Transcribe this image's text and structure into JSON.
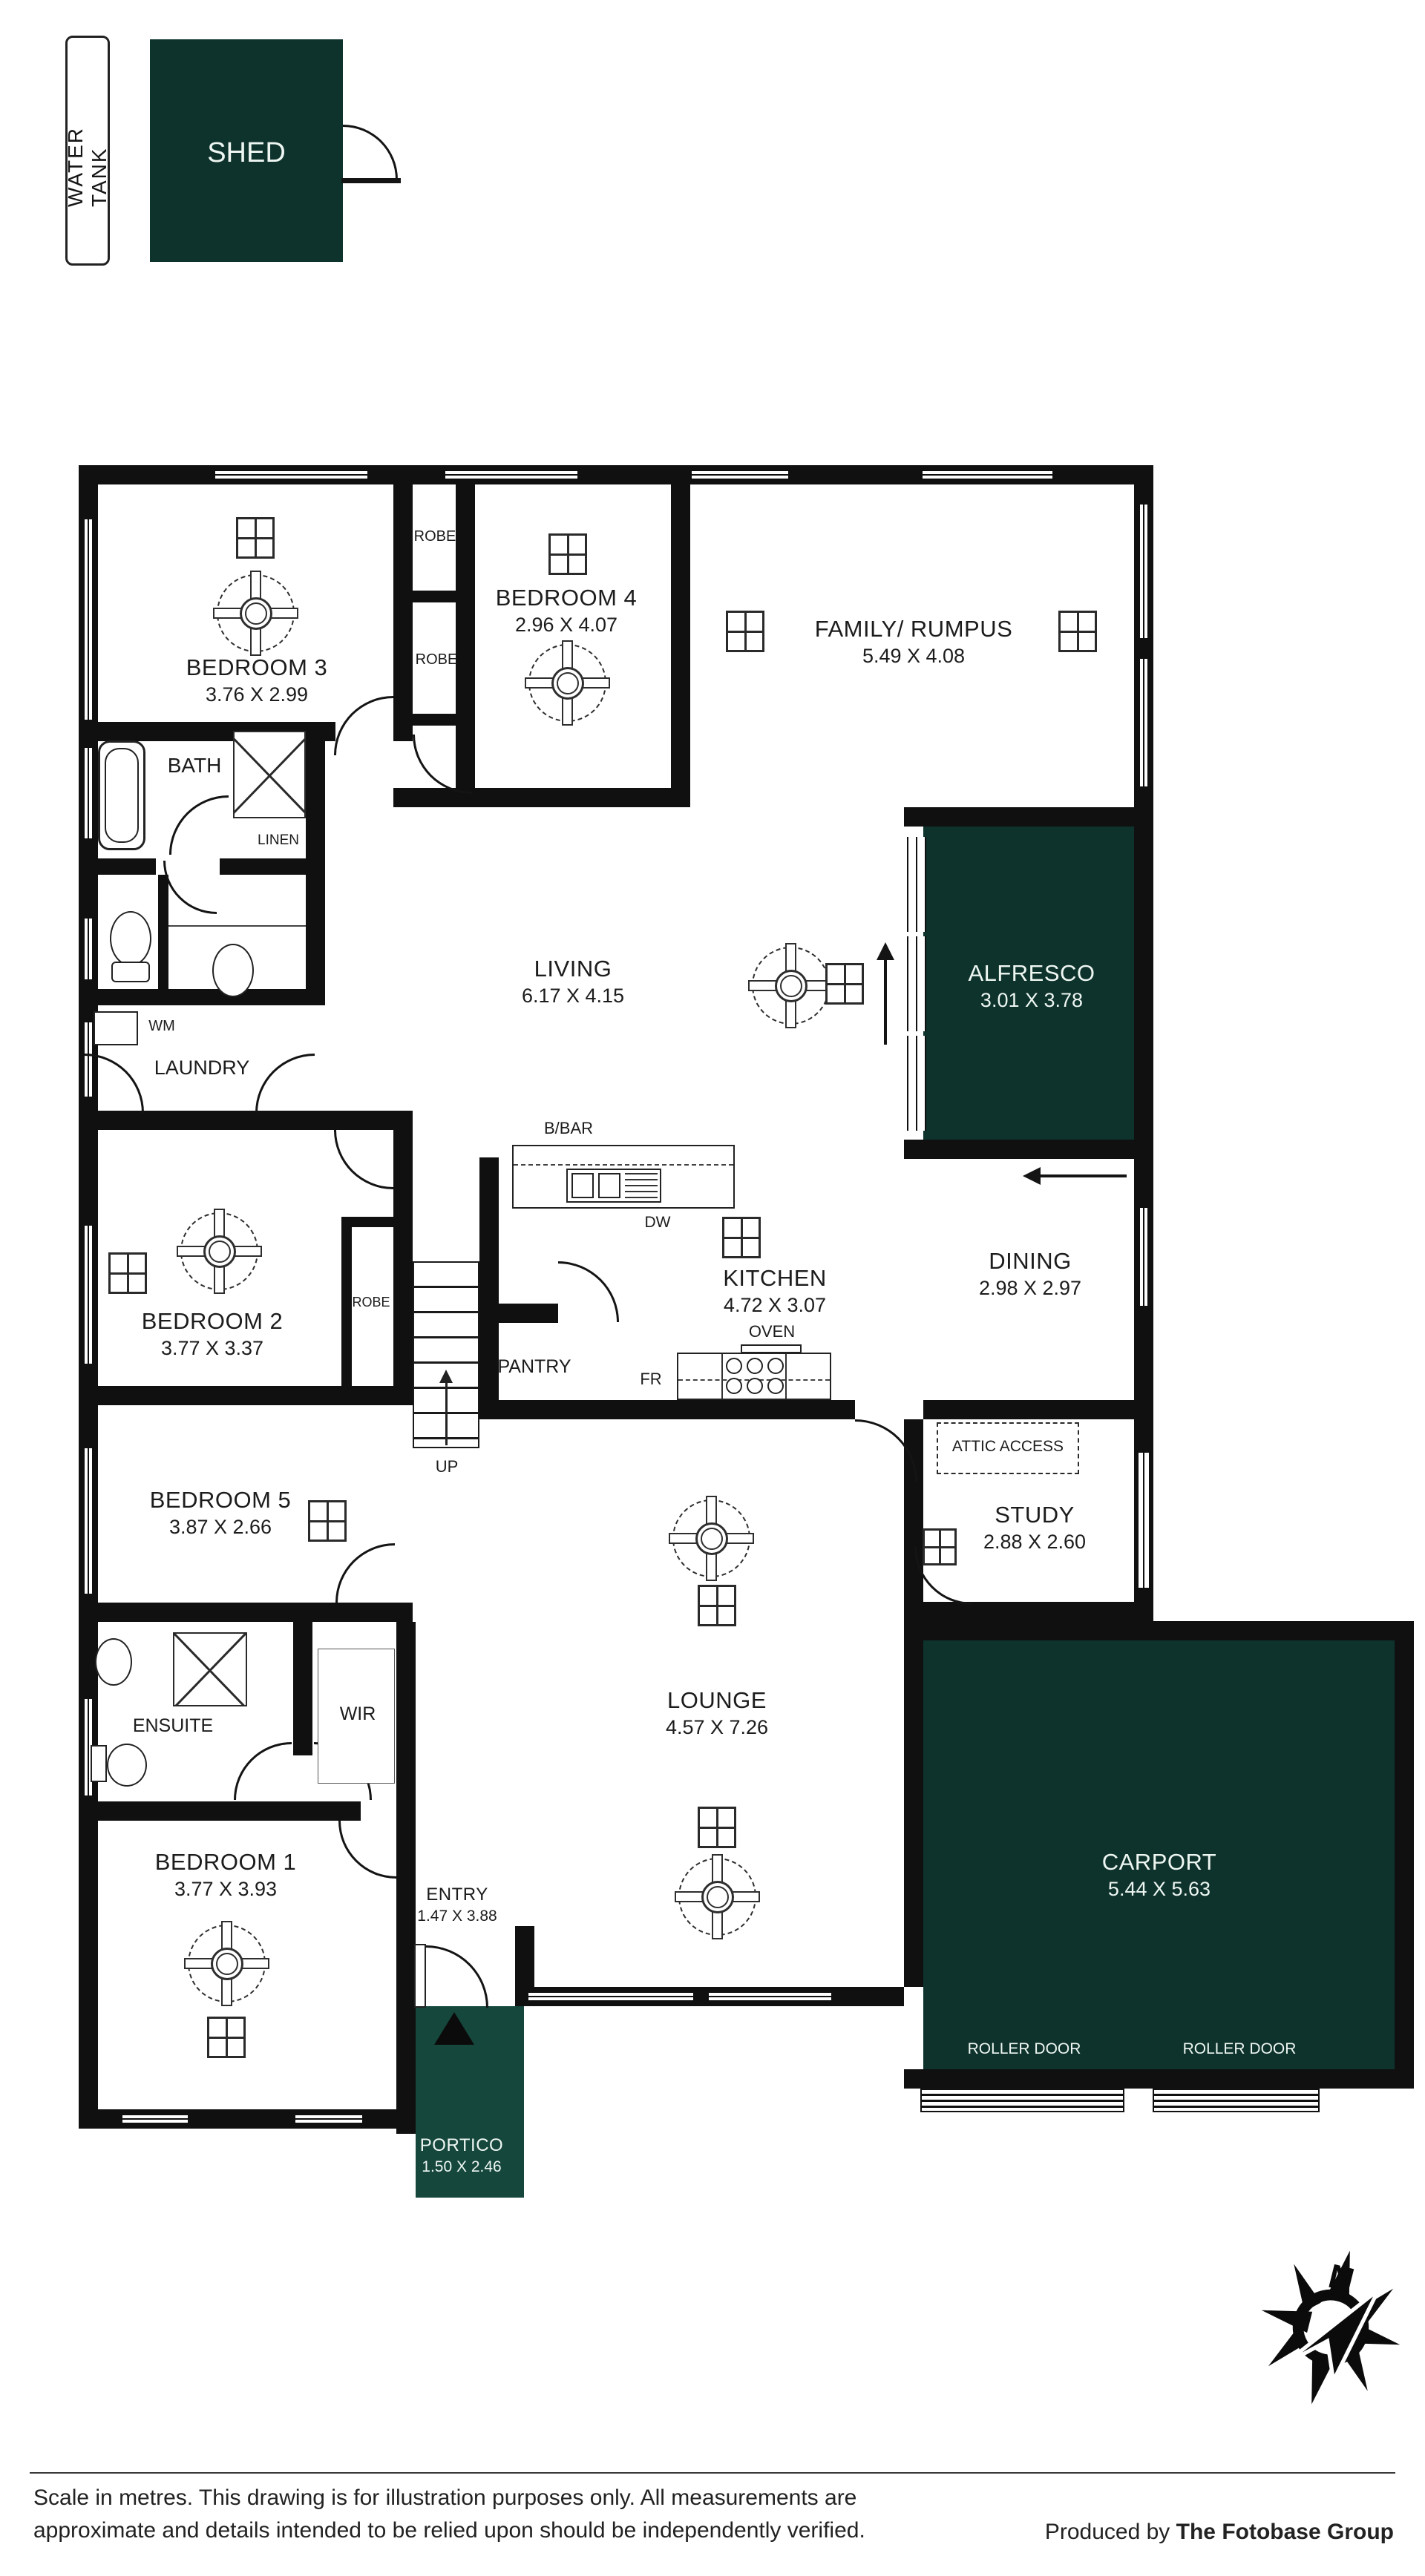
{
  "palette": {
    "green": "#0e332c",
    "wall": "#101010"
  },
  "site": {
    "water_tank": "WATER TANK",
    "shed": "SHED"
  },
  "rooms": {
    "bedroom3": {
      "name": "BEDROOM 3",
      "dims": "3.76 X 2.99"
    },
    "bedroom4": {
      "name": "BEDROOM 4",
      "dims": "2.96 X 4.07"
    },
    "family": {
      "name": "FAMILY/ RUMPUS",
      "dims": "5.49 X 4.08"
    },
    "living": {
      "name": "LIVING",
      "dims": "6.17 X 4.15"
    },
    "alfresco": {
      "name": "ALFRESCO",
      "dims": "3.01 X 3.78"
    },
    "kitchen": {
      "name": "KITCHEN",
      "dims": "4.72 X 3.07"
    },
    "dining": {
      "name": "DINING",
      "dims": "2.98 X 2.97"
    },
    "bedroom2": {
      "name": "BEDROOM 2",
      "dims": "3.77 X 3.37"
    },
    "bedroom5": {
      "name": "BEDROOM 5",
      "dims": "3.87 X 2.66"
    },
    "study": {
      "name": "STUDY",
      "dims": "2.88 X 2.60"
    },
    "lounge": {
      "name": "LOUNGE",
      "dims": "4.57 X 7.26"
    },
    "bedroom1": {
      "name": "BEDROOM 1",
      "dims": "3.77 X 3.93"
    },
    "entry": {
      "name": "ENTRY",
      "dims": "1.47 X 3.88"
    },
    "portico": {
      "name": "PORTICO",
      "dims": "1.50 X 2.46"
    },
    "carport": {
      "name": "CARPORT",
      "dims": "5.44 X 5.63"
    }
  },
  "labels": {
    "bath": "BATH",
    "linen": "LINEN",
    "laundry": "LAUNDRY",
    "wm": "WM",
    "robe": "ROBE",
    "pantry": "PANTRY",
    "fr": "FR",
    "dw": "DW",
    "bbar": "B/BAR",
    "oven": "OVEN",
    "up": "UP",
    "wir": "WIR",
    "ensuite": "ENSUITE",
    "attic": "ATTIC ACCESS",
    "roller_door": "ROLLER DOOR",
    "north": "N"
  },
  "footer": {
    "disclaimer_line1": "Scale in metres. This drawing is for illustration purposes only. All measurements are",
    "disclaimer_line2": "approximate and details intended to be relied upon should be independently verified.",
    "produced_by": "Produced by",
    "company": "The Fotobase Group"
  }
}
